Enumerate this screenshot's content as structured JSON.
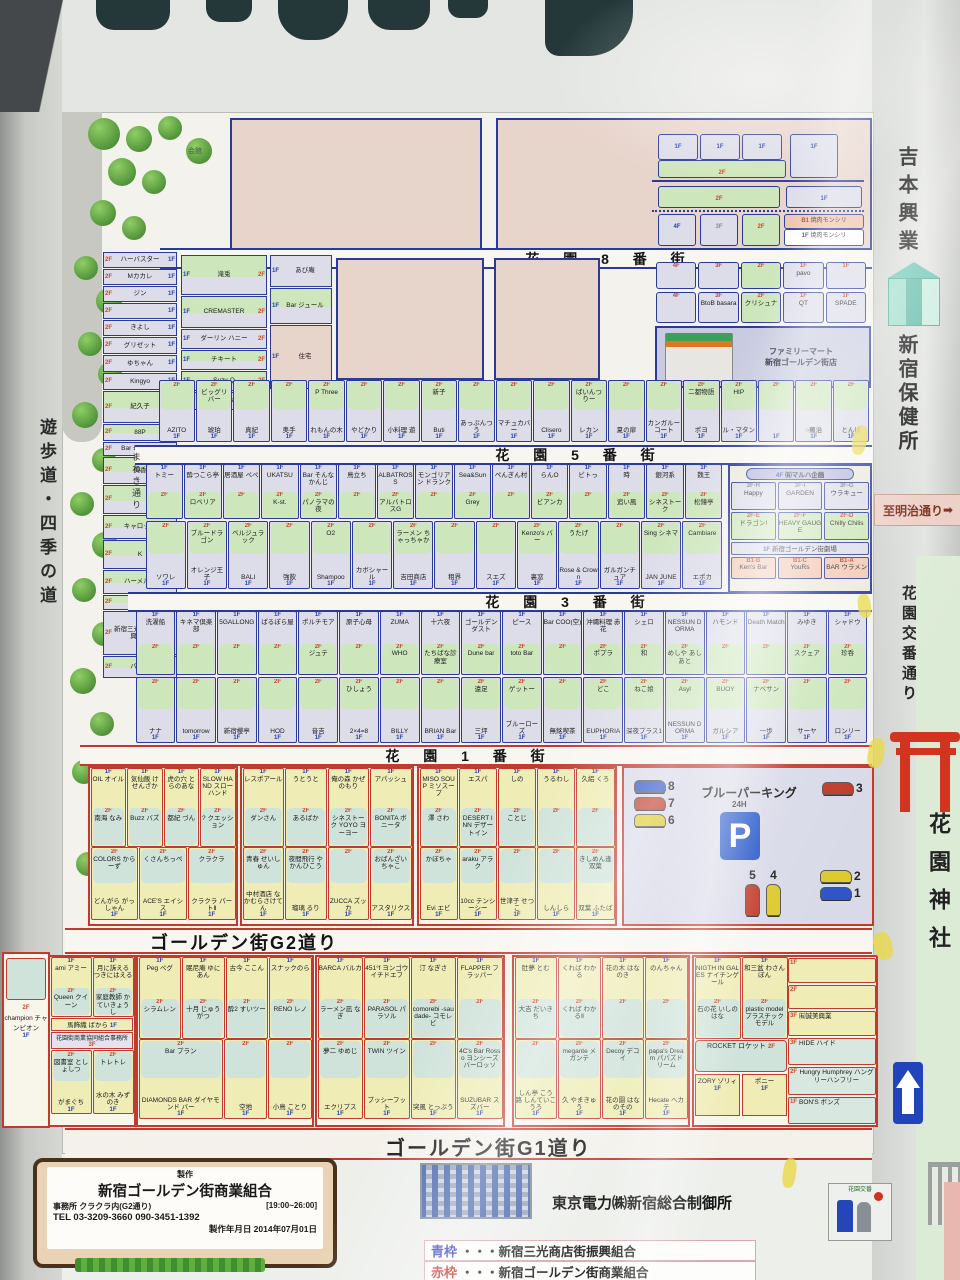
{
  "floors": {
    "f1": "1F",
    "f2": "2F",
    "f3": "3F",
    "f4": "4F",
    "b1": "B1"
  },
  "streets": {
    "s8": "花 園 8 番 街",
    "s5": "花 園 5 番 街",
    "s3": "花 園 3 番 街",
    "s1": "花 園 1 番 街",
    "g2": "ゴールデン街G2道り",
    "g1": "ゴールデン街G1道り",
    "maneki": "まねき通り"
  },
  "side": {
    "promenade": "遊歩道・四季の道",
    "yoshimoto": "吉本興業",
    "hoken": "新宿保健所",
    "meiji": "至明治通り",
    "meiji_arrow": "➡",
    "koban_street": "花園交番通り",
    "shrine": "花園神社",
    "koban": "花園交番",
    "kaikan": "会館"
  },
  "north": {
    "yakiniku": "焼肉モンシリ",
    "left_stack": [
      {
        "n": "ハーバスター",
        "h": 14
      },
      {
        "n": "Mカカレ",
        "h": 14
      },
      {
        "n": "ジン",
        "h": 14
      },
      {
        "n": "",
        "h": 14
      },
      {
        "n": "きよし",
        "h": 14
      },
      {
        "n": "グリゼット",
        "h": 15
      },
      {
        "n": "ゆちゃん",
        "h": 15
      },
      {
        "n": "Kingyo",
        "h": 15
      },
      {
        "n": "紀久子",
        "h": 30,
        "g": 1
      },
      {
        "n": "88P",
        "h": 15,
        "g": 1
      },
      {
        "n": "Bar 母となく",
        "h": 12
      },
      {
        "n": "美香",
        "h": 25,
        "g": 1
      },
      {
        "n": "",
        "h": 27,
        "g": 1
      },
      {
        "n": "キャロット",
        "h": 22,
        "g": 1
      },
      {
        "n": "K",
        "h": 27,
        "g": 1
      },
      {
        "n": "ハーメルン",
        "h": 22,
        "g": 1
      },
      {
        "n": "待夢",
        "h": 13,
        "g": 1
      },
      {
        "n": "新宿三光商店街振興組合",
        "h": 42
      },
      {
        "n": "バンビ",
        "h": 20,
        "g": 1
      }
    ],
    "mid_col1": [
      {
        "n": "滝兎",
        "h": 38,
        "g": 1
      },
      {
        "n": "CREMASTER",
        "h": 30,
        "g": 1
      },
      {
        "n": "ダーリン ハニー",
        "h": 18
      },
      {
        "n": "チキート",
        "h": 18,
        "g": 1
      },
      {
        "n": "Suzy-Q",
        "h": 18,
        "g": 1
      },
      {
        "n": "nagune",
        "h": 16,
        "g": 1
      }
    ],
    "mid_col2": [
      {
        "n": "あび庵",
        "h": 30
      },
      {
        "n": "Bar ジュール",
        "h": 34,
        "g": 1
      },
      {
        "n": "住宅",
        "h": 62,
        "plain": 1
      }
    ],
    "r8_row1": [
      {
        "f": "4F",
        "n": ""
      },
      {
        "f": "3F",
        "n": ""
      },
      {
        "f": "2F",
        "n": ""
      },
      {
        "f": "1F",
        "n": "pavo"
      },
      {
        "f": "1F",
        "n": ""
      }
    ],
    "r8_row2": [
      {
        "f": "4F",
        "n": ""
      },
      {
        "f": "3F",
        "n": "BtoB basara"
      },
      {
        "f": "2F",
        "n": "クリシュナ"
      },
      {
        "f": "1F",
        "n": "QT"
      },
      {
        "f": "1F",
        "n": "SPADE"
      }
    ],
    "famima": {
      "l1": "ファミリーマート",
      "l2": "新宿ゴールデン街店"
    },
    "row_above5": [
      {
        "n": "AZITO"
      },
      {
        "n": "琥珀",
        "s": "ビッグリバー"
      },
      {
        "n": "真紀"
      },
      {
        "n": "奥手"
      },
      {
        "n": "れもんの木",
        "s": "P Three"
      },
      {
        "n": "やどかり"
      },
      {
        "n": "小料理 遊"
      },
      {
        "n": "Buti",
        "s": "新子"
      },
      {
        "n": "あっぷんつう"
      },
      {
        "n": "マチュカバー"
      },
      {
        "n": "Clisero"
      },
      {
        "n": "レカン",
        "s": "ばいんつりー"
      },
      {
        "n": "夏の扉"
      },
      {
        "n": "カンガルーコート"
      },
      {
        "n": "ポヨ",
        "s": "二都物語"
      },
      {
        "n": "ル・マタン",
        "s": "HIP"
      },
      {
        "n": ""
      },
      {
        "n": "○羅治"
      },
      {
        "n": "とんぼ"
      }
    ],
    "b5_row1": [
      {
        "n": "トミー"
      },
      {
        "n": "酔つこら亭",
        "s": "ロベリア"
      },
      {
        "n": "居酒屋 ペペ"
      },
      {
        "n": "UKATSU",
        "s": "K-st."
      },
      {
        "n": "Bar そんなかんじ",
        "s": "パノラマの夜"
      },
      {
        "n": "鳥立ち"
      },
      {
        "n": "ALBATROSS",
        "s": "アルバトロスG"
      },
      {
        "n": "モンゴリアン ドランク"
      },
      {
        "n": "Sea&Sun",
        "s": "Grey"
      },
      {
        "n": "ぺんぎん村"
      },
      {
        "n": "らんO",
        "s": "ビアンカ"
      },
      {
        "n": "ビトっ"
      },
      {
        "n": "時",
        "s": "追い風"
      },
      {
        "n": "銀河系",
        "s": "シネストーク"
      },
      {
        "n": "魏王",
        "s": "松鐘亭"
      }
    ],
    "b5_row2": [
      {
        "n": "ソワレ"
      },
      {
        "n": "オレンジ王子",
        "s": "ブルードラゴン"
      },
      {
        "n": "BALI",
        "s": "ベルジュラック"
      },
      {
        "n": "強飲"
      },
      {
        "n": "Shampoo",
        "s": "O2"
      },
      {
        "n": "カボシャール"
      },
      {
        "n": "吉田商店",
        "s": "ラーメン ちゃっちゃか"
      },
      {
        "n": "租界"
      },
      {
        "n": "スエズ"
      },
      {
        "n": "裏窓",
        "s": "Kenzo's バー"
      },
      {
        "n": "Rose & Crown",
        "s": "うたげ"
      },
      {
        "n": "ガルガンチュア"
      },
      {
        "n": "JAN JUNE",
        "s": "Sing シネマ"
      },
      {
        "n": "エポカ",
        "s": "Cambiare"
      }
    ],
    "theater": {
      "pill_f": "4F",
      "pill": "㈲マルハ企画",
      "r3": [
        {
          "f": "3F-H",
          "n": "Happy"
        },
        {
          "f": "3F-I",
          "n": "GARDEN"
        },
        {
          "f": "3F-G",
          "n": "ウラキュー"
        }
      ],
      "r2": [
        {
          "f": "2F-E",
          "n": "ドラゴン!"
        },
        {
          "f": "2F-F",
          "n": "HEAVY GAUGE"
        },
        {
          "f": "2F-D",
          "n": "Chilly Chilis"
        }
      ],
      "r1f": "1F",
      "r1": "新宿ゴールデン街劇場",
      "rb": [
        {
          "f": "B1-B",
          "n": "Ken's Bar"
        },
        {
          "f": "B1-C",
          "n": "YouRs"
        },
        {
          "f": "B1-A",
          "n": "BAR ウラメン"
        }
      ]
    },
    "b3_row1": [
      {
        "n": "洗濯船"
      },
      {
        "n": "キネマ倶楽部"
      },
      {
        "n": "5GALLONG"
      },
      {
        "n": "ぱるぽら屋"
      },
      {
        "n": "ポルチモア",
        "s": "ジュテ"
      },
      {
        "n": "原子心母"
      },
      {
        "n": "ZUMA",
        "s": "WHO"
      },
      {
        "n": "十六夜",
        "s": "たちばな診療室"
      },
      {
        "n": "ゴールデンダスト",
        "s": "Dune bar"
      },
      {
        "n": "ピース",
        "s": "toto Bar"
      },
      {
        "n": "Bar COO(空)"
      },
      {
        "n": "沖縄料理 赤花",
        "s": "ポプラ"
      },
      {
        "n": "シェロ",
        "s": "和"
      },
      {
        "n": "NESSUN DORMA",
        "s": "めしや あしあと"
      },
      {
        "n": "ハモンド"
      },
      {
        "n": "Death Match"
      },
      {
        "n": "みゆき",
        "s": "スクェア"
      },
      {
        "n": "シャドウ",
        "s": "珍呑"
      }
    ],
    "b3_row2": [
      {
        "n": "ナナ"
      },
      {
        "n": "tomorrow"
      },
      {
        "n": "新宿櫻亭"
      },
      {
        "n": "HOD"
      },
      {
        "n": "音吉"
      },
      {
        "n": "2×4=8",
        "s": "ひしょう"
      },
      {
        "n": "BILLY"
      },
      {
        "n": "BRIAN Bar"
      },
      {
        "n": "三坪",
        "s": "遠足"
      },
      {
        "n": "ブルーローズ",
        "s": "ゲットー"
      },
      {
        "n": "無銘喫茶"
      },
      {
        "n": "EUPHORIA",
        "s": "どこ"
      },
      {
        "n": "深夜プラス1",
        "s": "ねこ娘"
      },
      {
        "n": "NESSUN DORMA",
        "s": "Asyl"
      },
      {
        "n": "ガルシア",
        "s": "BUOY"
      },
      {
        "n": "一歩",
        "s": "ナベサン"
      },
      {
        "n": "サーヤ"
      },
      {
        "n": "ロンリー"
      }
    ]
  },
  "south": {
    "b1a_r1": [
      {
        "n": "OIL オイル",
        "s": "南海 なみ"
      },
      {
        "n": "気仙飯 けせんざか",
        "s": "Buzz バズ"
      },
      {
        "n": "虎の穴 とらのあな",
        "s": "都紀 づん"
      },
      {
        "n": "SLOW HAND スローハンド",
        "s": "? クエッション"
      }
    ],
    "b1a_r2": [
      {
        "n": "どんがら がっしゃん",
        "s": "COLORS からーず"
      },
      {
        "n": "ACE'S エイシス",
        "s": "くさんちっぺ"
      },
      {
        "n": "クラクラ パートⅡ",
        "s": "クラクラ"
      }
    ],
    "b1b_r1": [
      {
        "n": "レスポアール",
        "s": "ダンさん"
      },
      {
        "n": "うとうと",
        "s": "あるばか"
      },
      {
        "n": "俺の森 かぜのもり",
        "s": "シネストーク YOYO ヨーヨー"
      },
      {
        "n": "アパッシュ",
        "s": "BONITA ボニータ"
      }
    ],
    "b1b_r2": [
      {
        "n": "中村酒店 なかむらさけてん",
        "s": "青春 せいしゅん"
      },
      {
        "n": "瑠璃 るり",
        "s": "夜間飛行 やかんひこう"
      },
      {
        "n": "ZUCCA ズッカ",
        "s": ""
      },
      {
        "n": "アスタリクス",
        "s": "おばんざい ちゃこ"
      }
    ],
    "b1c_r1": [
      {
        "n": "MISO SOUP ミソスープ",
        "s": "澤 さわ"
      },
      {
        "n": "エスパ",
        "s": "DESERT INN デザートイン"
      },
      {
        "n": "しの",
        "s": "ことじ"
      },
      {
        "n": "うるわし",
        "s": ""
      },
      {
        "n": "久絽 くろ",
        "s": ""
      }
    ],
    "b1c_r2": [
      {
        "n": "Evi エビ",
        "s": "かぼちゃ"
      },
      {
        "n": "10cc テンシーシー",
        "s": "araku アラク"
      },
      {
        "n": "世津子 せつこ",
        "s": ""
      },
      {
        "n": "しんしら",
        "s": ""
      },
      {
        "n": "双葉 ふたば",
        "s": "きしめん逢 双葉"
      }
    ],
    "parking": {
      "title": "ブルーパーキング",
      "hours": "24H",
      "p": "P",
      "cars_left": [
        {
          "n": "8",
          "c": "#2f55c8"
        },
        {
          "n": "7",
          "c": "#c03a28"
        },
        {
          "n": "6",
          "c": "#ddca2e"
        }
      ],
      "cars_tr": [
        {
          "n": "3",
          "c": "#c03a28"
        }
      ],
      "cars_mid": [
        {
          "n": "5",
          "c": "#c03a28"
        },
        {
          "n": "4",
          "c": "#ddca2e"
        }
      ],
      "cars_br": [
        {
          "n": "2",
          "c": "#ddca2e"
        },
        {
          "n": "1",
          "c": "#2f55c8"
        }
      ]
    },
    "g2_partial": "champion チャンピオン",
    "g2a_r1": [
      {
        "n": "ami アミー",
        "s": "Queen クイーン"
      },
      {
        "n": "月に訴える つきにはえる",
        "s": "家庭教師 かていきょうし"
      }
    ],
    "g2a_bar": "馬飾織 ばから",
    "g2a_office_f": "3F",
    "g2a_office": "花園街商業協同組合事務所",
    "g2a_r2": [
      {
        "n": "がまぐち",
        "s": "図書室 としょしつ"
      },
      {
        "n": "水の木 みずのき",
        "s": "トレトレ"
      }
    ],
    "g2b_r1": [
      {
        "n": "Peg ペグ",
        "s": "シラムレン"
      },
      {
        "n": "眠尼庵 ゆにあん",
        "s": "十月 じゅうがつ"
      },
      {
        "n": "古今 ここん",
        "s": "酔2 すいツー"
      },
      {
        "n": "スナックのら",
        "s": "RENO レノ"
      }
    ],
    "g2b_r2": [
      {
        "n": "DIAMONDS BAR ダイヤモンド バー",
        "s": "Bar プラン",
        "w": 2
      },
      {
        "n": "空地",
        "s": ""
      },
      {
        "n": "小鳥 ことり",
        "s": ""
      }
    ],
    "g2c_r1": [
      {
        "n": "BARCA バルカ",
        "s": "ラーメン凪 なぎ"
      },
      {
        "n": "451°f ヨンゴウイチドエフ",
        "s": "PARASOL パラソル"
      },
      {
        "n": "汀 なぎさ",
        "s": "comorebi -saudade- コモレビ"
      },
      {
        "n": "FLAPPER フラッパー",
        "s": ""
      }
    ],
    "g2c_r2": [
      {
        "n": "エクリプス",
        "s": "夢二 ゆめじ"
      },
      {
        "n": "プッシーフット",
        "s": "TWIN ツイン"
      },
      {
        "n": "突風 とっぷう",
        "s": ""
      },
      {
        "n": "SUZUBAR スズバー",
        "s": "4C's Bar Rosso ヨンシーズバーロッソ"
      }
    ],
    "g2d_r1": [
      {
        "n": "肚夢 とむ",
        "s": "大吉 だいきち"
      },
      {
        "n": "くれば わかる",
        "s": "くれば わかるⅡ"
      },
      {
        "n": "花の木 はなのき",
        "s": ""
      },
      {
        "n": "のんちゃん",
        "s": ""
      }
    ],
    "g2d_r2": [
      {
        "n": "しん亭 こう路 しんていこうろ",
        "s": ""
      },
      {
        "n": "久 やまきゅう",
        "s": "megante メガンテ"
      },
      {
        "n": "花の園 はなのその",
        "s": "Decoy デコイ"
      },
      {
        "n": "Hecate ヘカテ",
        "s": "papa's Dream パパズドリーム"
      }
    ],
    "g2e_r1": [
      {
        "n": "NIGTH IN GALES ナイチンゲール",
        "s": "石の花 いしのはな"
      },
      {
        "n": "和三盆 わさんぼん",
        "s": "plastic model プラスチックモデル"
      }
    ],
    "g2e_col1": [
      {
        "f": "1F",
        "n": ""
      },
      {
        "f": "2F",
        "n": ""
      },
      {
        "f": "3F",
        "n": "㈲誠美興業"
      }
    ],
    "g2e_rocket": "ROCKET ロケット",
    "g2e_zory": "ZORY ゾリィ",
    "g2e_pony": "ポニー",
    "g2e_col2": [
      {
        "f": "3F",
        "n": "HIDE ハイド"
      },
      {
        "f": "2F",
        "n": "Hungry Humphrey ハングリーハンフリー"
      },
      {
        "f": "1F",
        "n": "BON'S ボンズ"
      }
    ]
  },
  "bottom": {
    "maker_title": "製作",
    "maker_name": "新宿ゴールデン街商業組合",
    "maker_office": "事務所 クラクラ内(G2通り)",
    "maker_hours": "[19:00~26:00]",
    "maker_tel": "TEL 03-3209-3660  090-3451-1392",
    "maker_date": "製作年月日 2014年07月01日",
    "tepco": "東京電力㈱新宿総合制御所",
    "legend": [
      {
        "key": "青枠",
        "text": "・・・新宿三光商店街振興組合",
        "color": "#2233bb"
      },
      {
        "key": "赤枠",
        "text": "・・・新宿ゴールデン街商業組合",
        "color": "#cc2222"
      }
    ]
  }
}
